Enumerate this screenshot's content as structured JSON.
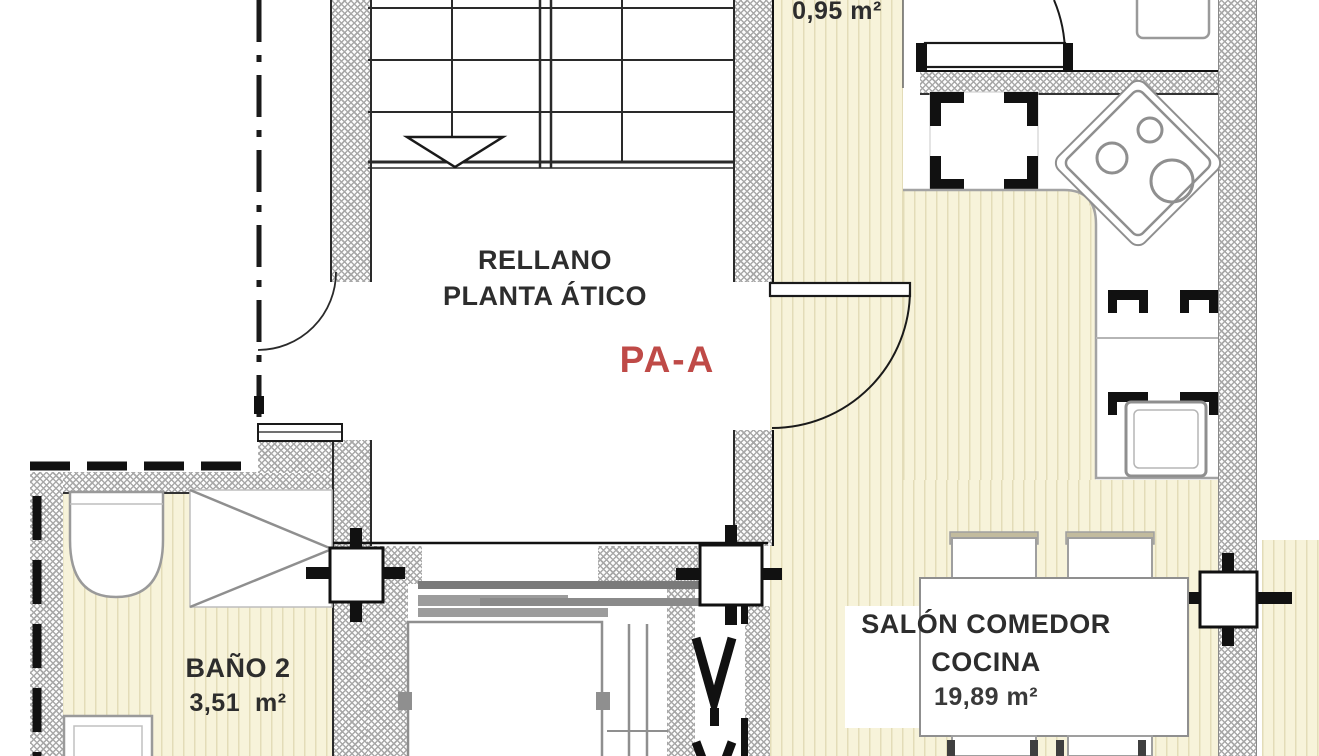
{
  "plan_labels": {
    "landing_line1": "RELLANO",
    "landing_line2": "PLANTA ÁTICO",
    "unit_code": "PA-A",
    "vestibule_area": "0,95 m²",
    "bathroom_name": "BAÑO 2",
    "bathroom_area": "3,51  m²",
    "living_line1": "SALÓN COMEDOR",
    "living_line2": "COCINA",
    "living_area": "19,89 m²"
  },
  "rooms": [
    {
      "name": "RELLANO PLANTA ÁTICO",
      "area": ""
    },
    {
      "name": "PA-A",
      "area": "0,95 m²"
    },
    {
      "name": "BAÑO 2",
      "area": "3,51 m²"
    },
    {
      "name": "SALÓN COMEDOR COCINA",
      "area": "19,89 m²"
    }
  ],
  "colors": {
    "floor": "#f7f3da",
    "floor_stripe": "#e3dcb8",
    "wall_hatch": "#a8a8a8",
    "line_dark": "#1a1a1a",
    "fixture_gray": "#8f8f8f",
    "accent_red": "#bf4a47"
  }
}
